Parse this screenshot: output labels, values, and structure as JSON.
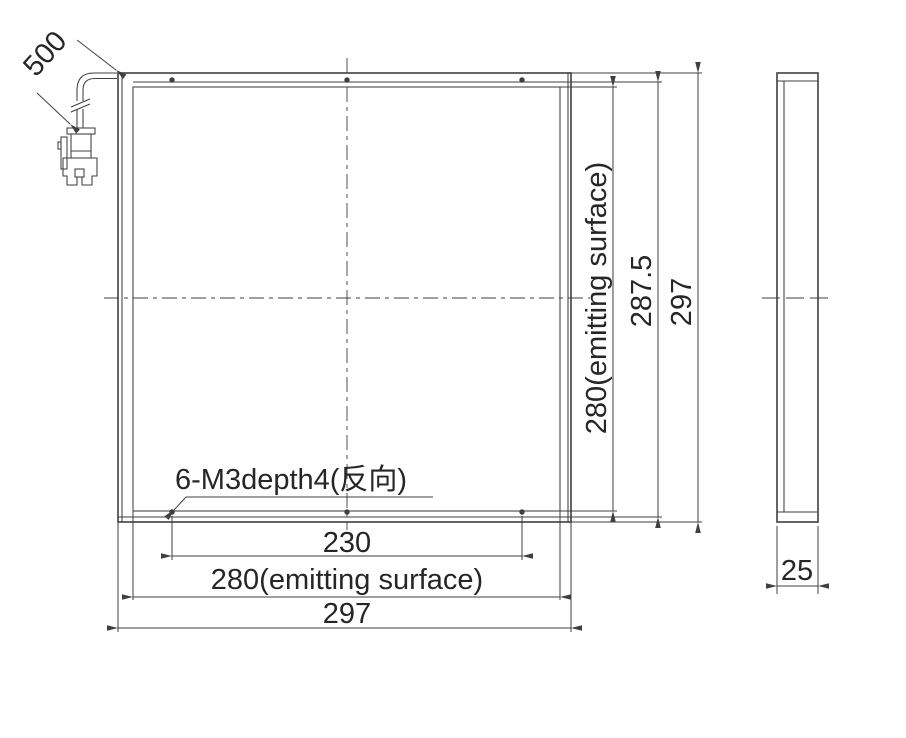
{
  "front_view": {
    "cable_length": "500",
    "thread_note": "6-M3depth4(反向)",
    "hole_spacing": "230",
    "emitting_width": "280(emitting surface)",
    "overall_width": "297",
    "emitting_height": "280(emitting surface)",
    "mounting_height": "287.5",
    "overall_height": "297"
  },
  "side_view": {
    "thickness": "25"
  },
  "colors": {
    "line": "#3f3f3f",
    "text": "#262626",
    "background": "#ffffff"
  }
}
